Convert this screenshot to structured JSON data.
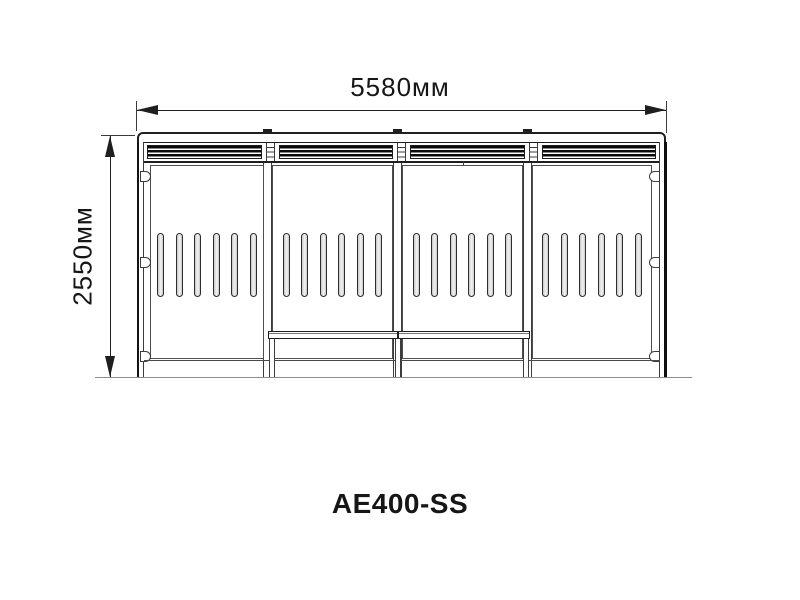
{
  "drawing_title": "AE400-SS",
  "dimensions": {
    "width": "5580мм",
    "height": "2550мм"
  },
  "structure": {
    "bays": 4,
    "slots_per_bay": 6,
    "internal_posts": 3,
    "side_tabs_per_side": 3,
    "bench_legs": 3,
    "roof_ticks": 3
  },
  "colors": {
    "line": "#1f1f1f",
    "thin_line": "#3c3c3c",
    "louver": "#0a0a0a",
    "slot_fill": "#c9c9c9",
    "ground": "#8c8c8c",
    "text": "#161616",
    "background": "#ffffff"
  }
}
